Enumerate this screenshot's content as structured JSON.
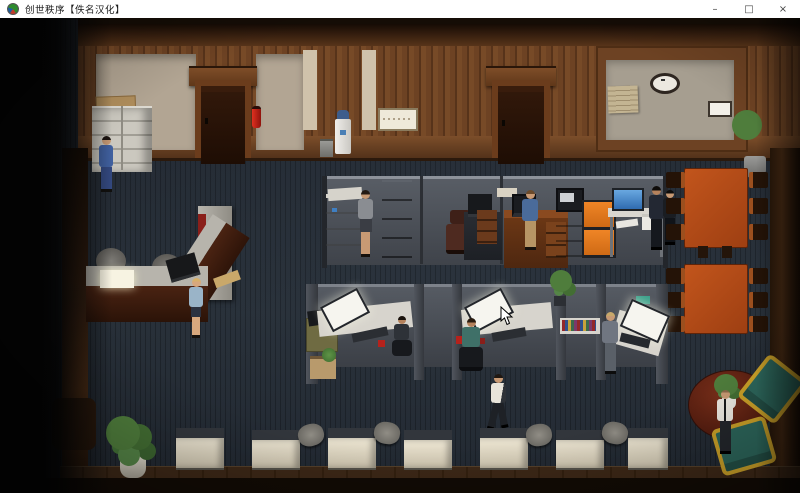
{
  "window": {
    "title": "创世秩序【佚名汉化】",
    "controls": {
      "minimize": "–",
      "maximize": "□",
      "close": "×"
    }
  },
  "palette": {
    "titlebar_bg": "#ffffff",
    "titlebar_text": "#1a1a1a",
    "floor": "#242b34",
    "wall_wood": "#6d4223",
    "wall_beige": "#b2a593",
    "panel_beige": "#a69e90",
    "door_dark": "#2f1709",
    "fire_extinguisher_red": "#c01818",
    "partition_gray": "#4e545c",
    "desk_white": "#d7d4cd",
    "desk_wood": "#8a4a20",
    "cabinet_orange": "#e0751d",
    "table_wood": "#b24918",
    "round_table": "#5c2014",
    "chair_teal": "#2c655a",
    "chair_frame_gold": "#caa028",
    "plant_green": "#4f7d3c",
    "screen_glow": "#f6f5ef",
    "screen_blue": "#3f7fc2"
  }
}
